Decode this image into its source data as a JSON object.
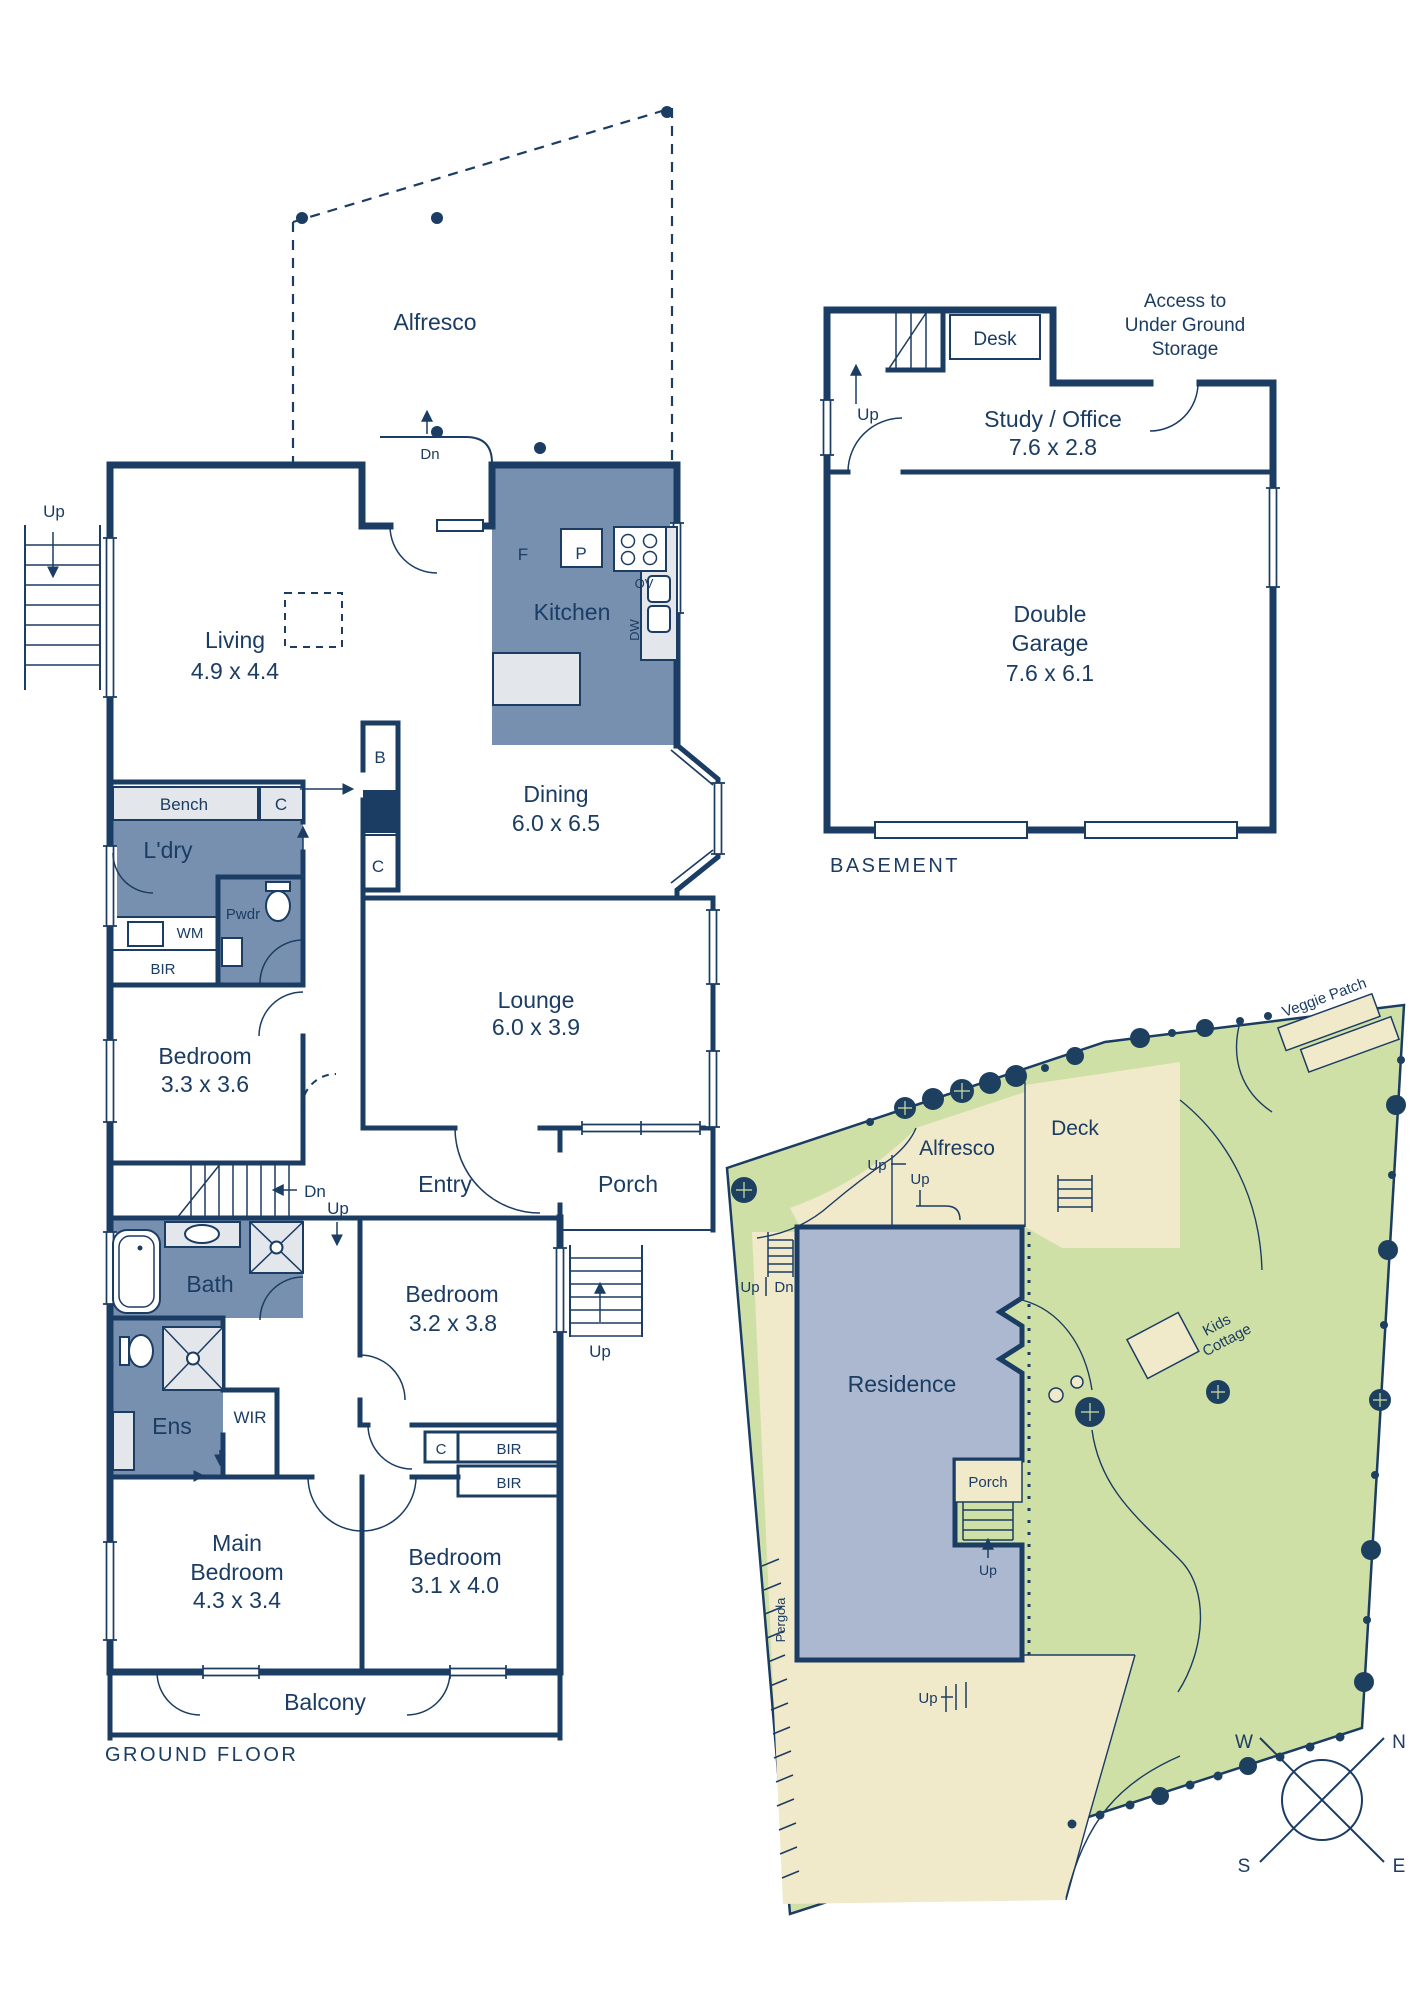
{
  "colors": {
    "wall_navy": "#1b3c63",
    "wet_area_blue": "#7890b0",
    "fixture_gray": "#e3e6ea",
    "residence_blue": "#abb8cf",
    "grass_green": "#cfe0a6",
    "paving_cream": "#f0e9ca",
    "tree_navy": "#1d4060"
  },
  "gf": {
    "title": "GROUND FLOOR",
    "alfresco": "Alfresco",
    "stairs": {
      "up": "Up",
      "dn": "Dn"
    },
    "living": {
      "name": "Living",
      "dims": "4.9 x 4.4"
    },
    "kitchen": {
      "name": "Kitchen",
      "f": "F",
      "p": "P",
      "ov": "OV",
      "dw": "DW"
    },
    "bench": "Bench",
    "laundry": "L'dry",
    "wm": "WM",
    "pwdr": "Pwdr",
    "bir": "BIR",
    "closets": {
      "b": "B",
      "c": "C"
    },
    "dining": {
      "name": "Dining",
      "dims": "6.0 x 6.5"
    },
    "lounge": {
      "name": "Lounge",
      "dims": "6.0 x 3.9"
    },
    "bed_rear": {
      "name": "Bedroom",
      "dims": "3.3 x 3.6"
    },
    "entry": "Entry",
    "porch": "Porch",
    "bath": "Bath",
    "bed_mid": {
      "name": "Bedroom",
      "dims": "3.2 x 3.8"
    },
    "ens": "Ens",
    "wir": "WIR",
    "main_bed": {
      "l1": "Main",
      "l2": "Bedroom",
      "dims": "4.3 x 3.4"
    },
    "bed_front": {
      "name": "Bedroom",
      "dims": "3.1 x 4.0"
    },
    "balcony": "Balcony"
  },
  "bm": {
    "title": "BASEMENT",
    "up": "Up",
    "desk": "Desk",
    "access": {
      "l1": "Access to",
      "l2": "Under Ground",
      "l3": "Storage"
    },
    "study": {
      "name": "Study / Office",
      "dims": "7.6 x 2.8"
    },
    "garage": {
      "l1": "Double",
      "l2": "Garage",
      "dims": "7.6 x 6.1"
    }
  },
  "site": {
    "alfresco": "Alfresco",
    "deck": "Deck",
    "residence": "Residence",
    "veggie_patch": "Veggie Patch",
    "kids_cottage": {
      "l1": "Kids",
      "l2": "Cottage"
    },
    "pergola": "Pergola",
    "porch": "Porch",
    "up": "Up",
    "dn": "Dn",
    "compass": {
      "n": "N",
      "s": "S",
      "e": "E",
      "w": "W"
    }
  }
}
